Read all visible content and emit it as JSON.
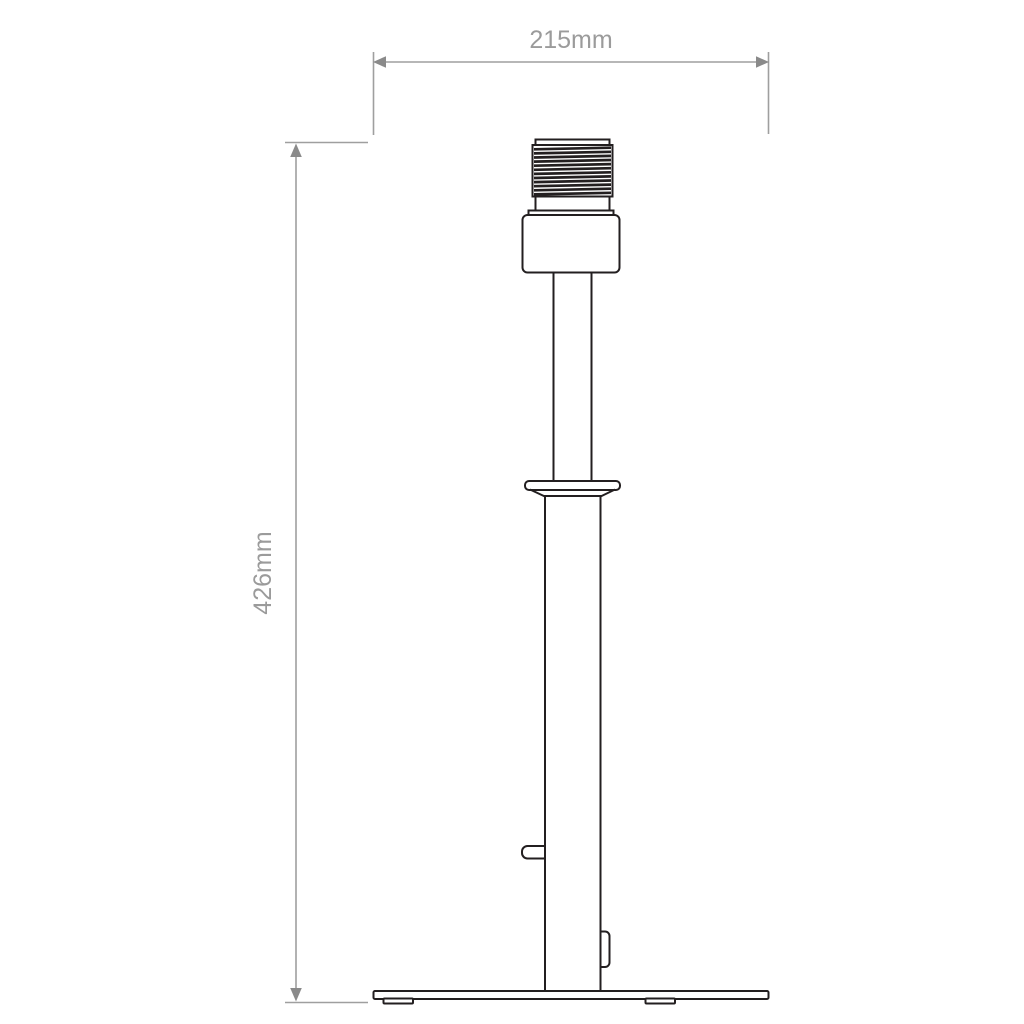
{
  "drawing": {
    "dimensions": {
      "width": {
        "label": "215mm",
        "value_mm": 215
      },
      "height": {
        "label": "426mm",
        "value_mm": 426
      }
    },
    "colors": {
      "outline": "#231f20",
      "dimension_line": "#9f9f9f",
      "dimension_arrow": "#8a8a8a",
      "dimension_text": "#9b9b9b",
      "background": "#ffffff"
    }
  }
}
